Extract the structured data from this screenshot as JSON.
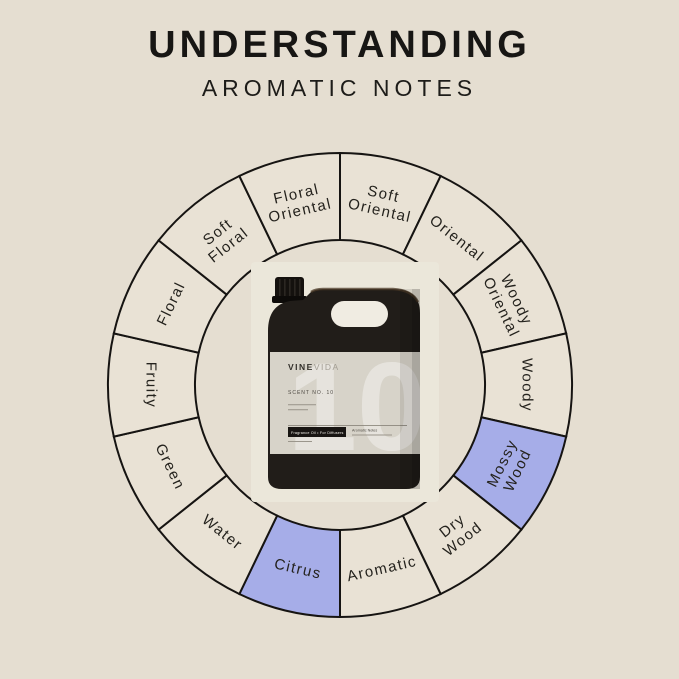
{
  "title": "UNDERSTANDING",
  "subtitle": "AROMATIC NOTES",
  "wheel": {
    "segments": [
      {
        "label": "Soft Oriental",
        "lines": [
          "Soft",
          "Oriental"
        ],
        "highlighted": false
      },
      {
        "label": "Oriental",
        "lines": [
          "Oriental"
        ],
        "highlighted": false
      },
      {
        "label": "Woody Oriental",
        "lines": [
          "Woody",
          "Oriental"
        ],
        "highlighted": false
      },
      {
        "label": "Woody",
        "lines": [
          "Woody"
        ],
        "highlighted": false
      },
      {
        "label": "Mossy Wood",
        "lines": [
          "Mossy",
          "Wood"
        ],
        "highlighted": true
      },
      {
        "label": "Dry Wood",
        "lines": [
          "Dry",
          "Wood"
        ],
        "highlighted": false
      },
      {
        "label": "Aromatic",
        "lines": [
          "Aromatic"
        ],
        "highlighted": false
      },
      {
        "label": "Citrus",
        "lines": [
          "Citrus"
        ],
        "highlighted": true
      },
      {
        "label": "Water",
        "lines": [
          "Water"
        ],
        "highlighted": false
      },
      {
        "label": "Green",
        "lines": [
          "Green"
        ],
        "highlighted": false
      },
      {
        "label": "Fruity",
        "lines": [
          "Fruity"
        ],
        "highlighted": false
      },
      {
        "label": "Floral",
        "lines": [
          "Floral"
        ],
        "highlighted": false
      },
      {
        "label": "Soft Floral",
        "lines": [
          "Soft",
          "Floral"
        ],
        "highlighted": false
      },
      {
        "label": "Floral Oriental",
        "lines": [
          "Floral",
          "Oriental"
        ],
        "highlighted": false
      }
    ],
    "segment_color": "#e9e2d5",
    "highlight_color": "#a6ade8",
    "outline_color": "#161412",
    "label_color": "#24221d"
  },
  "bottle": {
    "brand_bold": "VINE",
    "brand_light": "VIDA",
    "scent_line": "SCENT NO. 10",
    "watermark": "10",
    "badge_label": "Fragrance Oil • For Diffusers",
    "notes_label": "Aromatic Notes"
  },
  "colors": {
    "background": "#e5ded1",
    "title_text": "#171614",
    "bottle_body": "#211d19",
    "bottle_label": "#d7d3c9"
  }
}
